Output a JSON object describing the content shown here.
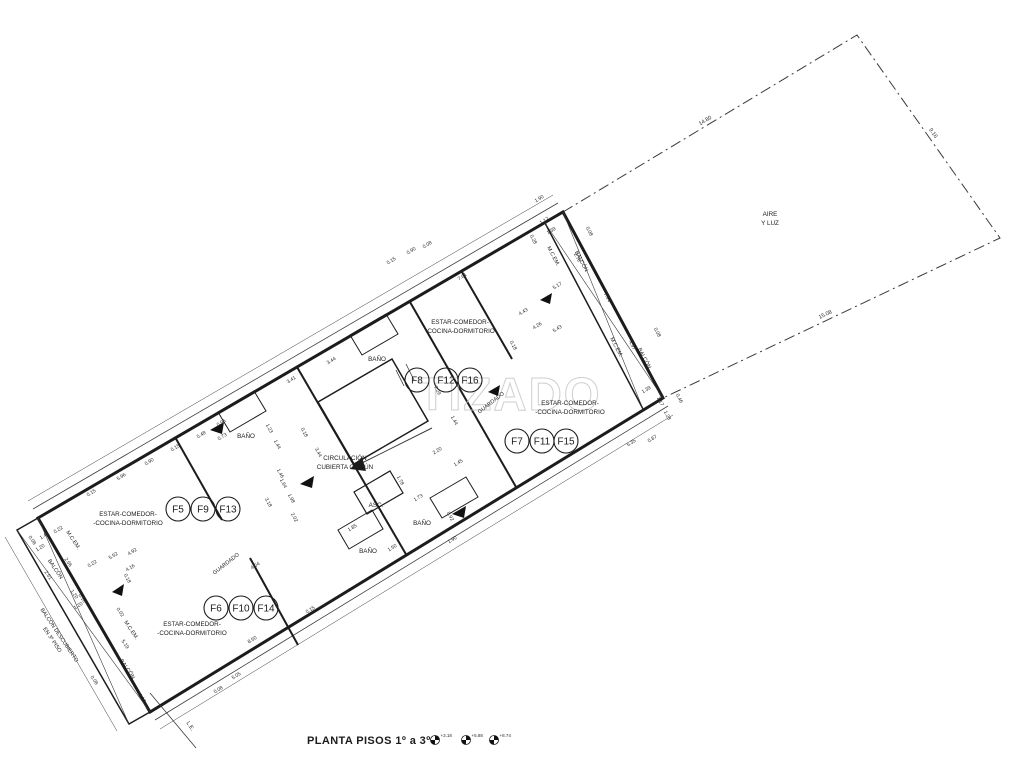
{
  "title": {
    "text": "PLANTA PISOS 1º a 3º"
  },
  "levels": [
    {
      "value": "+3.18"
    },
    {
      "value": "+5.88"
    },
    {
      "value": "+8.74"
    }
  ],
  "watermark": {
    "text": "TIZADO"
  },
  "lot": {
    "dims": [
      {
        "t": "14.80",
        "x": 706,
        "y": 122,
        "r": -31
      },
      {
        "t": "9.16",
        "x": 932,
        "y": 134,
        "r": 55
      },
      {
        "t": "15.08",
        "x": 826,
        "y": 316,
        "r": -26
      }
    ]
  },
  "rooms": [
    {
      "id": "air-light",
      "lines": [
        "AIRE",
        "Y LUZ"
      ],
      "x": 770,
      "y": 216
    },
    {
      "id": "unit-top",
      "lines": [
        "ESTAR-COMEDOR-",
        "-COCINA-DORMITORIO"
      ],
      "x": 460,
      "y": 324
    },
    {
      "id": "unit-right",
      "lines": [
        "ESTAR-COMEDOR-",
        "-COCINA-DORMITORIO"
      ],
      "x": 570,
      "y": 405
    },
    {
      "id": "unit-left",
      "lines": [
        "ESTAR-COMEDOR-",
        "-COCINA-DORMITORIO"
      ],
      "x": 128,
      "y": 516
    },
    {
      "id": "unit-bottom",
      "lines": [
        "ESTAR-COMEDOR-",
        "-COCINA-DORMITORIO"
      ],
      "x": 192,
      "y": 626
    },
    {
      "id": "circulation",
      "lines": [
        "CIRCULACIÓN",
        "CUBIERTA COMÚN"
      ],
      "x": 345,
      "y": 460
    },
    {
      "id": "bath-top",
      "lines": [
        "BAÑO"
      ],
      "x": 377,
      "y": 361
    },
    {
      "id": "bath-left",
      "lines": [
        "BAÑO"
      ],
      "x": 246,
      "y": 438
    },
    {
      "id": "bath-right",
      "lines": [
        "BAÑO"
      ],
      "x": 422,
      "y": 525
    },
    {
      "id": "bath-center",
      "lines": [
        "BAÑO"
      ],
      "x": 368,
      "y": 553
    },
    {
      "id": "elevator",
      "lines": [
        "ASC."
      ],
      "x": 376,
      "y": 507
    }
  ],
  "units": [
    {
      "label": "F8",
      "x": 417,
      "y": 380
    },
    {
      "label": "F12",
      "x": 446,
      "y": 380
    },
    {
      "label": "F16",
      "x": 470,
      "y": 380
    },
    {
      "label": "F7",
      "x": 517,
      "y": 441
    },
    {
      "label": "F11",
      "x": 542,
      "y": 441
    },
    {
      "label": "F15",
      "x": 566,
      "y": 441
    },
    {
      "label": "F5",
      "x": 178,
      "y": 509
    },
    {
      "label": "F9",
      "x": 203,
      "y": 509
    },
    {
      "label": "F13",
      "x": 228,
      "y": 509
    },
    {
      "label": "F6",
      "x": 216,
      "y": 608
    },
    {
      "label": "F10",
      "x": 241,
      "y": 608
    },
    {
      "label": "F14",
      "x": 266,
      "y": 608
    }
  ],
  "wall_labels": [
    {
      "lines": [
        "BALCÓN DESCUBIERTO",
        "EN 3º PISO"
      ],
      "x": 58,
      "y": 636,
      "rot": 56
    },
    {
      "lines": [
        "BALCÓN"
      ],
      "x": 54,
      "y": 570,
      "rot": 56
    },
    {
      "lines": [
        "BALCÓN"
      ],
      "x": 126,
      "y": 670,
      "rot": 56
    },
    {
      "lines": [
        "M.C.EM."
      ],
      "x": 72,
      "y": 541,
      "rot": 56
    },
    {
      "lines": [
        "M.C.EM."
      ],
      "x": 130,
      "y": 631,
      "rot": 56
    },
    {
      "lines": [
        "M.C.EM."
      ],
      "x": 552,
      "y": 257,
      "rot": 62
    },
    {
      "lines": [
        "M.C.EM."
      ],
      "x": 615,
      "y": 348,
      "rot": 62
    },
    {
      "lines": [
        "BALCÓN"
      ],
      "x": 580,
      "y": 262,
      "rot": 62
    },
    {
      "lines": [
        "BALCÓN"
      ],
      "x": 643,
      "y": 359,
      "rot": 62
    },
    {
      "lines": [
        "GUARDADO"
      ],
      "x": 492,
      "y": 404,
      "rot": -38
    },
    {
      "lines": [
        "GUARDADO"
      ],
      "x": 227,
      "y": 565,
      "rot": -38
    },
    {
      "lines": [
        "L.E."
      ],
      "x": 189,
      "y": 727,
      "rot": 56
    }
  ],
  "dimensions": [
    {
      "t": "0.15",
      "x": 92,
      "y": 494,
      "r": -31
    },
    {
      "t": "5.96",
      "x": 122,
      "y": 478,
      "r": -31
    },
    {
      "t": "0.90",
      "x": 150,
      "y": 463,
      "r": -31
    },
    {
      "t": "0.15",
      "x": 176,
      "y": 449,
      "r": -31
    },
    {
      "t": "0.96",
      "x": 222,
      "y": 424,
      "r": -31
    },
    {
      "t": "3.41",
      "x": 292,
      "y": 381,
      "r": -31
    },
    {
      "t": "3.44",
      "x": 332,
      "y": 362,
      "r": -31
    },
    {
      "t": "0.15",
      "x": 392,
      "y": 262,
      "r": -31
    },
    {
      "t": "0.90",
      "x": 412,
      "y": 252,
      "r": -31
    },
    {
      "t": "0.08",
      "x": 428,
      "y": 246,
      "r": -31
    },
    {
      "t": "7.61",
      "x": 463,
      "y": 278,
      "r": -31
    },
    {
      "t": "1.17",
      "x": 545,
      "y": 222,
      "r": -31
    },
    {
      "t": "1.39",
      "x": 552,
      "y": 232,
      "r": -31
    },
    {
      "t": "1.90",
      "x": 540,
      "y": 200,
      "r": -31
    },
    {
      "t": "0.28",
      "x": 532,
      "y": 240,
      "r": 62
    },
    {
      "t": "2.78",
      "x": 576,
      "y": 258,
      "r": 62
    },
    {
      "t": "0.08",
      "x": 588,
      "y": 232,
      "r": 62
    },
    {
      "t": "7.94",
      "x": 606,
      "y": 298,
      "r": 62
    },
    {
      "t": "4.97",
      "x": 631,
      "y": 346,
      "r": 62
    },
    {
      "t": "0.08",
      "x": 656,
      "y": 333,
      "r": 62
    },
    {
      "t": "5.17",
      "x": 558,
      "y": 287,
      "r": -31
    },
    {
      "t": "1.39",
      "x": 647,
      "y": 391,
      "r": -31
    },
    {
      "t": "1.17",
      "x": 659,
      "y": 402,
      "r": 62
    },
    {
      "t": "1.28",
      "x": 666,
      "y": 416,
      "r": 62
    },
    {
      "t": "0.87",
      "x": 653,
      "y": 440,
      "r": -31
    },
    {
      "t": "5.35",
      "x": 632,
      "y": 444,
      "r": -31
    },
    {
      "t": "0.46",
      "x": 678,
      "y": 399,
      "r": 62
    },
    {
      "t": "4.43",
      "x": 524,
      "y": 313,
      "r": -31
    },
    {
      "t": "4.26",
      "x": 538,
      "y": 327,
      "r": -31
    },
    {
      "t": "5.43",
      "x": 558,
      "y": 330,
      "r": -31
    },
    {
      "t": "0.18",
      "x": 512,
      "y": 346,
      "r": 62
    },
    {
      "t": "2.20",
      "x": 438,
      "y": 452,
      "r": -31
    },
    {
      "t": "1.45",
      "x": 459,
      "y": 464,
      "r": -31
    },
    {
      "t": "1.78",
      "x": 399,
      "y": 481,
      "r": 62
    },
    {
      "t": "1.73",
      "x": 419,
      "y": 499,
      "r": -31
    },
    {
      "t": "0.92",
      "x": 449,
      "y": 517,
      "r": 62
    },
    {
      "t": "1.90",
      "x": 453,
      "y": 541,
      "r": -31
    },
    {
      "t": "7.29",
      "x": 436,
      "y": 391,
      "r": 62
    },
    {
      "t": "1.44",
      "x": 453,
      "y": 421,
      "r": 62
    },
    {
      "t": "3.44",
      "x": 317,
      "y": 453,
      "r": 62
    },
    {
      "t": "0.18",
      "x": 303,
      "y": 433,
      "r": 62
    },
    {
      "t": "1.85",
      "x": 353,
      "y": 529,
      "r": -31
    },
    {
      "t": "1.50",
      "x": 393,
      "y": 549,
      "r": -31
    },
    {
      "t": "0.48",
      "x": 202,
      "y": 436,
      "r": -31
    },
    {
      "t": "0.73",
      "x": 223,
      "y": 438,
      "r": -31
    },
    {
      "t": "1.23",
      "x": 268,
      "y": 429,
      "r": 62
    },
    {
      "t": "1.44",
      "x": 276,
      "y": 445,
      "r": 62
    },
    {
      "t": "1.46",
      "x": 279,
      "y": 474,
      "r": 62
    },
    {
      "t": "1.64",
      "x": 282,
      "y": 484,
      "r": 62
    },
    {
      "t": "1.98",
      "x": 290,
      "y": 499,
      "r": 62
    },
    {
      "t": "2.02",
      "x": 293,
      "y": 518,
      "r": 62
    },
    {
      "t": "3.18",
      "x": 267,
      "y": 503,
      "r": 62
    },
    {
      "t": "1.40",
      "x": 45,
      "y": 537,
      "r": -31
    },
    {
      "t": "1.20",
      "x": 41,
      "y": 549,
      "r": -31
    },
    {
      "t": "0.22",
      "x": 59,
      "y": 531,
      "r": -31
    },
    {
      "t": "2.66",
      "x": 67,
      "y": 563,
      "r": 56
    },
    {
      "t": "2.61",
      "x": 47,
      "y": 576,
      "r": 56
    },
    {
      "t": "5.52",
      "x": 114,
      "y": 557,
      "r": -31
    },
    {
      "t": "4.92",
      "x": 133,
      "y": 553,
      "r": -31
    },
    {
      "t": "4.16",
      "x": 131,
      "y": 569,
      "r": -31
    },
    {
      "t": "0.22",
      "x": 93,
      "y": 565,
      "r": -31
    },
    {
      "t": "0.18",
      "x": 126,
      "y": 579,
      "r": 62
    },
    {
      "t": "5.19",
      "x": 124,
      "y": 645,
      "r": 56
    },
    {
      "t": "0.02",
      "x": 119,
      "y": 613,
      "r": 56
    },
    {
      "t": "1.20",
      "x": 73,
      "y": 595,
      "r": 56
    },
    {
      "t": "0.10",
      "x": 81,
      "y": 599,
      "r": 56
    },
    {
      "t": "1.20",
      "x": 79,
      "y": 607,
      "r": -31
    },
    {
      "t": "0.08",
      "x": 93,
      "y": 681,
      "r": 56
    },
    {
      "t": "1.10",
      "x": 141,
      "y": 699,
      "r": 56
    },
    {
      "t": "0.08",
      "x": 31,
      "y": 541,
      "r": 56
    },
    {
      "t": "4.04",
      "x": 256,
      "y": 567,
      "r": -31
    },
    {
      "t": "8.50",
      "x": 253,
      "y": 641,
      "r": -31
    },
    {
      "t": "5.05",
      "x": 237,
      "y": 677,
      "r": -31
    },
    {
      "t": "0.08",
      "x": 219,
      "y": 691,
      "r": -31
    },
    {
      "t": "0.15",
      "x": 311,
      "y": 611,
      "r": -31
    }
  ]
}
